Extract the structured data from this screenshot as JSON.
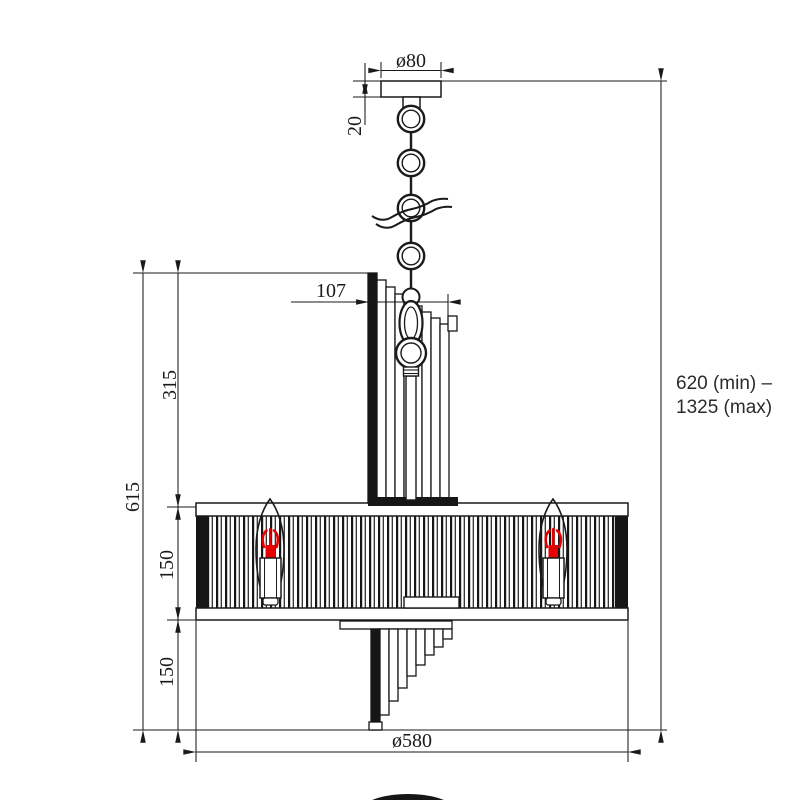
{
  "drawing": {
    "title": "chandelier pendant technical dimension drawing",
    "colors": {
      "line": "#1a1a1a",
      "filament_red": "#e60000",
      "background": "#ffffff"
    },
    "dimensions": {
      "canopy_diameter": "ø80",
      "canopy_height": "20",
      "inner_column_width": "107",
      "upper_section_height": "315",
      "shade_height": "150",
      "lower_cascade_height": "150",
      "total_body_height": "615",
      "suspension_line1": "620 (min) –",
      "suspension_line2": "1325 (max)",
      "shade_diameter": "ø580"
    }
  }
}
